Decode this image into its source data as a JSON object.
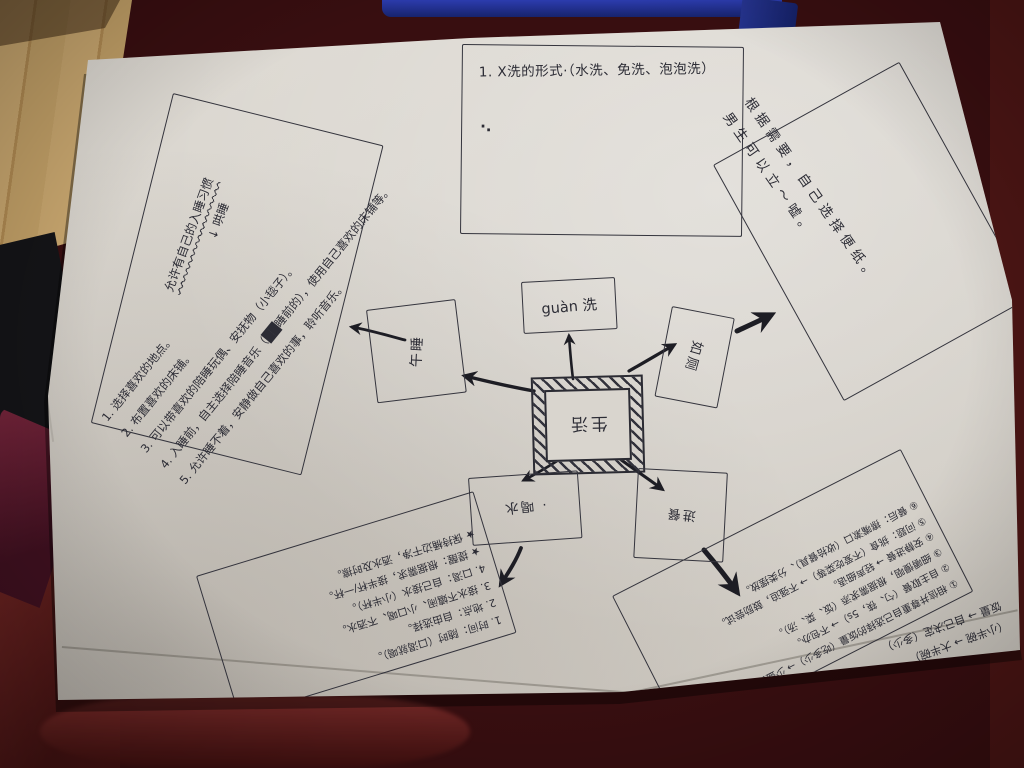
{
  "photo": {
    "paper_color": "#d9d5cf",
    "table_color": "#3a0f10",
    "floor_color": "#c9a76f",
    "strap_color": "#222f93",
    "ink_color": "#2c2c35"
  },
  "mindmap": {
    "center_label": "生活",
    "nodes": {
      "guanxi_label": "guàn 洗",
      "nap_label": "午睡",
      "toilet_label": "如厕",
      "water_label": "· 喝水",
      "meal_label": "进餐"
    },
    "forms_box": {
      "heading": "1. X洗的形式·（水洗、免洗、泡泡洗）",
      "bullet": "·."
    },
    "nap_box": {
      "header": "允许有自己的入睡习惯",
      "header_sub": "↓ 哄睡",
      "items": [
        "1. 选择喜欢的地点。",
        "2. 布置喜欢的床铺。",
        "3. 可以带喜欢的陪睡玩偶、安抚物（小毯子）。",
        "4. 入睡前，自主选择陪睡音乐（██睡前的），使用自己喜欢的床铺等。",
        "5. 允许睡不着，安静做自己喜欢的事，聆听音乐。"
      ]
    },
    "toilet_box": {
      "line1": "根据需要，自己选择便纸。",
      "line2": "男生可以立～嘘。"
    },
    "water_box": {
      "lines": [
        "1. 时间：随时（口渴就喝）。",
        "2. 地点：自由选择。",
        "3. 接水不嬉闹、小口喝、不洒水。",
        "4. 口渴：自己接水（小半杯）。",
        "★ 提醒：根据需求，接半杯/一杯。",
        "★ 保持桶边干净，洒水及时擦。"
      ]
    },
    "meal_box": {
      "lines": [
        "① 相信并尊重自己选择的饭量（吃多少）→ 少盛多添。",
        "② 自主取餐（勺、筷，5s）→ 不包办。",
        "③ 细嚼慢咽，根据需求添（饭、菜、汤）。",
        "④ 安静进餐 → 轻声细语。",
        "⑤ 问题：挑食（不爱吃菜等）→ 不强迫，鼓励尝试。",
        "⑥ 餐后：擦嘴漱口（收拾餐具）、分类摆放。"
      ],
      "notes": [
        "（小半碗 → 大半碗）",
        "饭量 → 自己决定（多少）"
      ]
    }
  }
}
